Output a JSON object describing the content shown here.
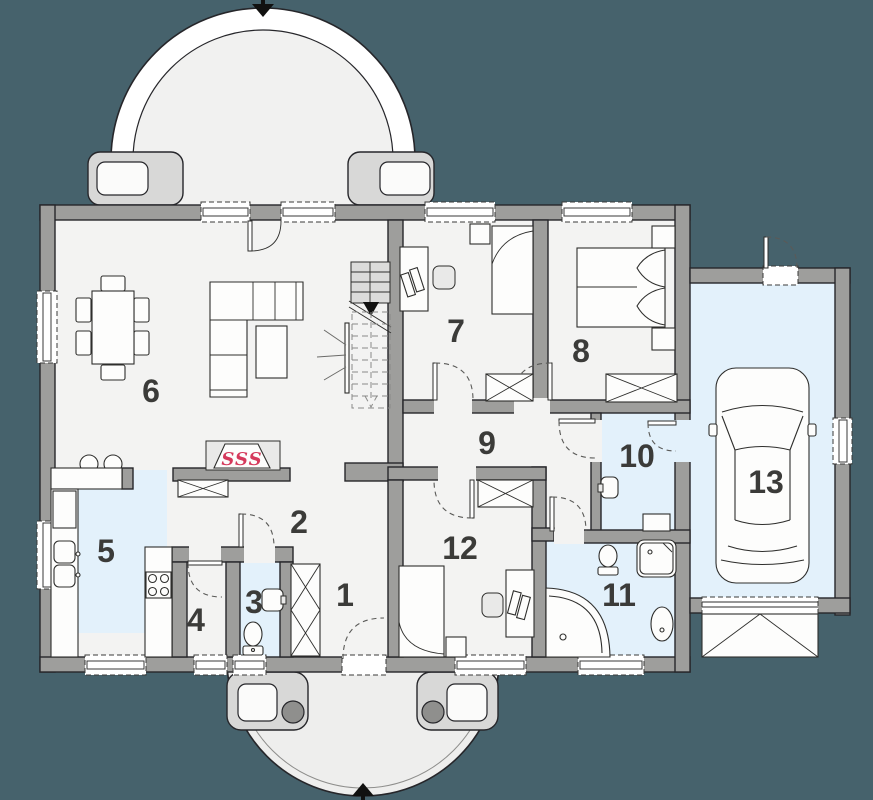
{
  "rooms": [
    {
      "number": "1",
      "floor": "standard"
    },
    {
      "number": "2",
      "floor": "standard"
    },
    {
      "number": "3",
      "floor": "tiled-blue"
    },
    {
      "number": "4",
      "floor": "standard"
    },
    {
      "number": "5",
      "floor": "tiled-blue"
    },
    {
      "number": "6",
      "floor": "standard"
    },
    {
      "number": "7",
      "floor": "standard"
    },
    {
      "number": "8",
      "floor": "standard"
    },
    {
      "number": "9",
      "floor": "standard"
    },
    {
      "number": "10",
      "floor": "tiled-blue"
    },
    {
      "number": "11",
      "floor": "tiled-blue"
    },
    {
      "number": "12",
      "floor": "standard"
    },
    {
      "number": "13",
      "floor": "tiled-blue"
    }
  ],
  "fireplace": {
    "symbol": "SSS",
    "color": "#d5395b"
  },
  "entry_arrows": {
    "top": "down",
    "bottom": "up"
  },
  "colors": {
    "background": "#46626c",
    "wall_fill": "#9e9e9c",
    "outline": "#26262a",
    "floor": "#f3f3f2",
    "wet_floor": "#e3f1fb",
    "porch_floor": "#eeeeed",
    "stair_fill": "#dcdcdb",
    "accent_red": "#d5395b"
  }
}
